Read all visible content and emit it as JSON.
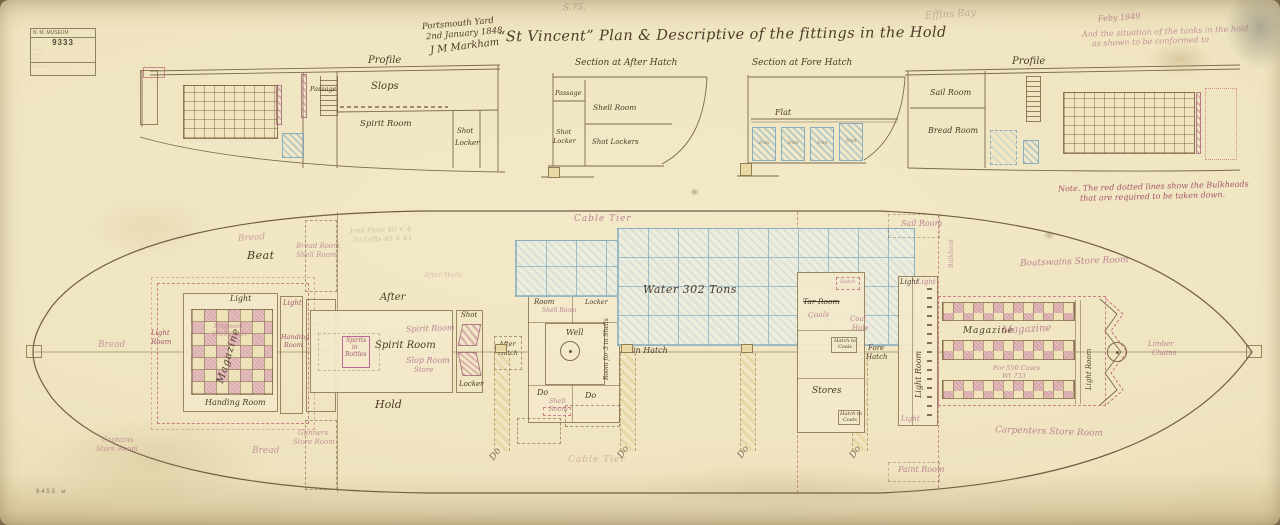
{
  "palette": {
    "paper": "#efe4bf",
    "ink": "#4a3c28",
    "red_ink": "#a4576c",
    "red_faded": "#bb8492",
    "blue": "#82a9bd",
    "tank_fill": "#eeeddc",
    "magazine_pink": "#c4748e",
    "cell_yellow": "#ecdda6",
    "pencil": "#8f8672"
  },
  "stamp": {
    "header": "N. M. MUSEUM",
    "number": "9333",
    "rows": [
      "· · · ·",
      "· · · ·",
      "· · · ·"
    ],
    "footer": "· · · · · ·"
  },
  "header": {
    "shelfmark": "S.75.",
    "yard1": "Portsmouth Yard",
    "yard2": "2nd January 1848",
    "signature": "J M Markham",
    "title": "“St Vincent”   Plan & Descriptive of the fittings in the Hold",
    "pencil": "Effins Bay",
    "red1": "Feby 1849",
    "red2": "And the situation of the tanks in the hold",
    "red3": "as shown to be conformed to"
  },
  "profile_fwd": {
    "title": "Profile",
    "passage": "Passage",
    "slops": "Slops",
    "spirit": "Spirit Room",
    "shot1": "Shot",
    "shot2": "Locker"
  },
  "section_after": {
    "title": "Section at After Hatch",
    "passage": "Passage",
    "shell": "Shell Room",
    "shot1": "Shot",
    "shot2": "Locker",
    "lockers": "Shot Lockers"
  },
  "section_fore": {
    "title": "Section at Fore Hatch",
    "flat": "Flat",
    "iron": "Iron"
  },
  "profile_aft": {
    "title": "Profile",
    "sail": "Sail Room",
    "bread": "Bread Room",
    "note1": "Note. The red dotted lines show the Bulkheads",
    "note2": "that are required to be taken down."
  },
  "plan": {
    "stern": {
      "bread_top": "Bread",
      "beat": "Beat",
      "bread_left": "Bread",
      "bread_bottom": "Bread",
      "cap1": "Captains",
      "cap2": "Store Room",
      "br1": "Bread Room",
      "br2": "Shell Room",
      "gun1": "Gunners",
      "gun2": "Store Room"
    },
    "mag_aft": {
      "light": "Light",
      "name": "Magazine",
      "handing": "Handing Room",
      "lr1": "Light",
      "lr2": "Room",
      "prop1": "Proposed",
      "prop2": "Shell Room",
      "sa1": "Small",
      "sa2": "Arms",
      "sa3": "&",
      "sa4": "Bread",
      "lob_light": "Light",
      "lob1": "Handing",
      "lob2": "Room"
    },
    "spirit": {
      "after": "After",
      "hold": "Hold",
      "name": "Spirit Room",
      "red_name": "Spirit Room",
      "slop": "Slop Room",
      "store": "Store",
      "b1": "Spirits",
      "b2": "in",
      "b3": "Bottles",
      "shot": "Shot",
      "locker": "Locker",
      "ah1": "After",
      "ah2": "Hatch"
    },
    "well": {
      "s1": "Shell",
      "s2": "Room",
      "red": "Shell Room",
      "c1": "Chain Cable",
      "c2": "Locker",
      "well": "Well",
      "do1": "Do",
      "do2": "Do",
      "rb1": "Shell",
      "rb2": "Room",
      "rot": "Room for 5 in Shells"
    },
    "mid": {
      "ct_top": "Cable Tier",
      "ct_bot": "Cable Tier",
      "water": "Water 302 Tons",
      "main_hatch": "Main Hatch",
      "do": "Do"
    },
    "fore": {
      "tar": "Tar Room",
      "coals": "Coals",
      "coal1": "Coal",
      "coal2": "Hole",
      "hc1": "Hatch to",
      "hc2": "Coals",
      "fh1": "Fore",
      "fh2": "Hatch",
      "stores": "Stores",
      "sail": "Sail Room",
      "paint": "Paint Room",
      "bulkhead": "Bulkhead",
      "hatch": "Hatch"
    },
    "mag_fore": {
      "name": "Magazine",
      "red_name": "Magazine",
      "cases": "For 550 Cases",
      "wt": "Wt 733",
      "light_room": "Light Room",
      "light": "Light",
      "light_red": "Light",
      "lamp": "Light"
    },
    "bow": {
      "boats": "Boatswains Store Room",
      "carp": "Carpenters Store Room",
      "lim1": "Limber",
      "lim2": "Chains"
    },
    "pencil": {
      "p1": "Iron Plate 40 × 4",
      "p2": "To Lofts 40 × 43",
      "p3": "After Walls"
    }
  },
  "footer": {
    "mark": "6453 w"
  }
}
